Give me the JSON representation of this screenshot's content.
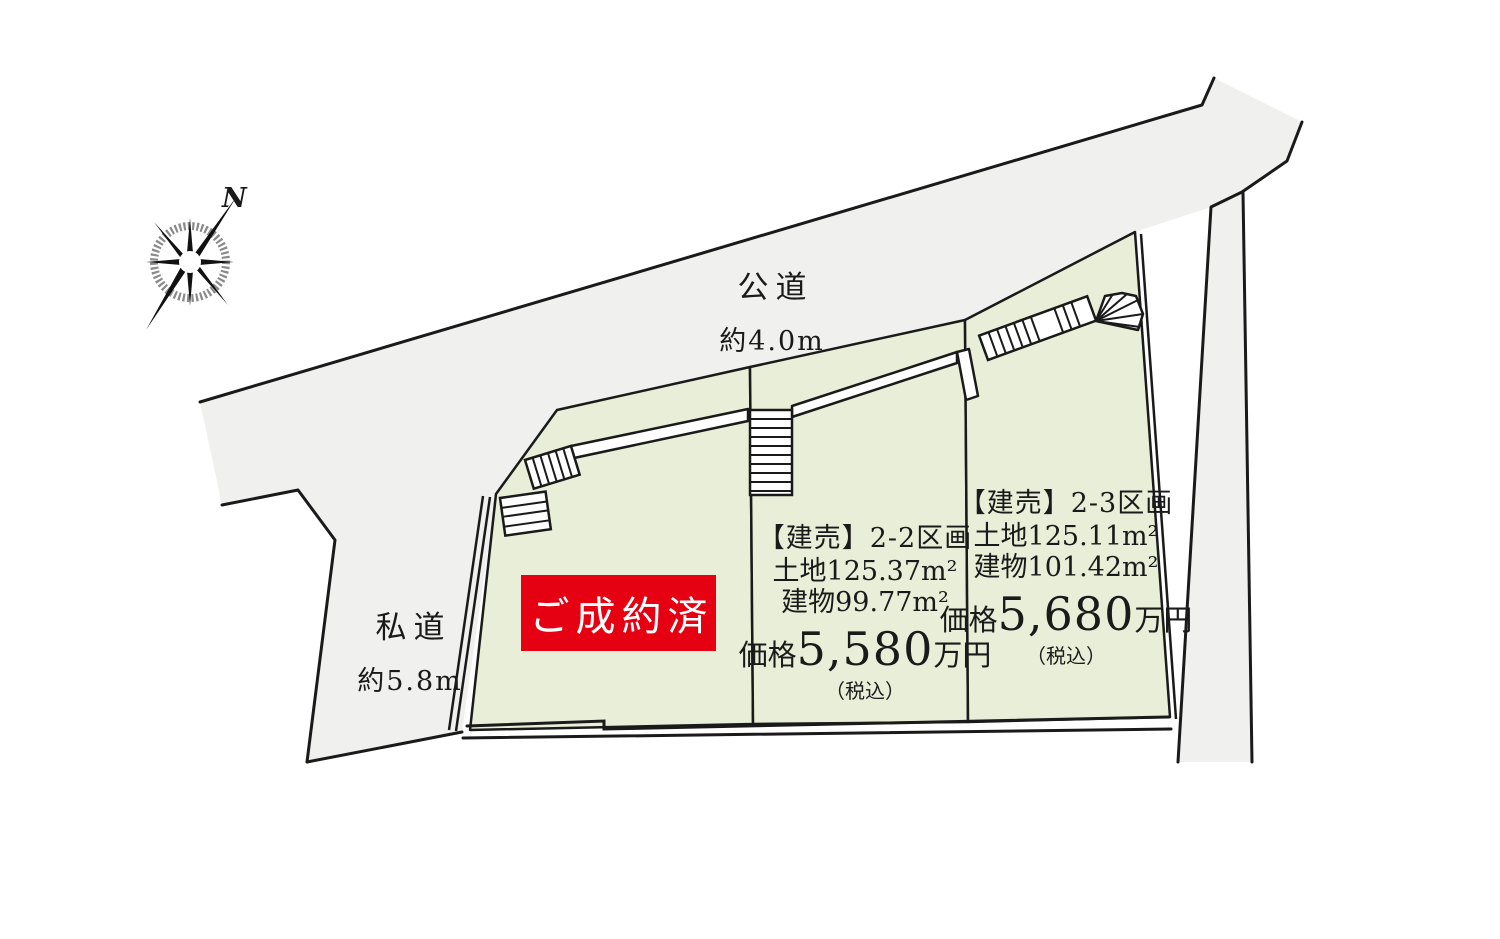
{
  "compass": {
    "north_label": "N"
  },
  "roads": {
    "public": {
      "name": "公道",
      "width": "約4.0m"
    },
    "private": {
      "name": "私道",
      "width": "約5.8m"
    }
  },
  "parcels": {
    "lot21_sold": {
      "status_label": "ご成約済"
    },
    "lot22": {
      "title": "【建売】2-2区画",
      "land_area": "土地125.37m²",
      "building_area": "建物99.77m²",
      "price_label": "価格",
      "price_value": "5,580",
      "price_unit": "万円",
      "tax_note": "（税込）"
    },
    "lot23": {
      "title": "【建売】2-3区画",
      "land_area": "土地125.11m²",
      "building_area": "建物101.42m²",
      "price_label": "価格",
      "price_value": "5,680",
      "price_unit": "万円",
      "tax_note": "（税込）"
    }
  },
  "colors": {
    "parcel_green": "#e8eed7",
    "road_gray": "#f0f0ee",
    "sold_red": "#e50112",
    "line_black": "#1a1a1a",
    "badge_text": "#ffffff"
  }
}
